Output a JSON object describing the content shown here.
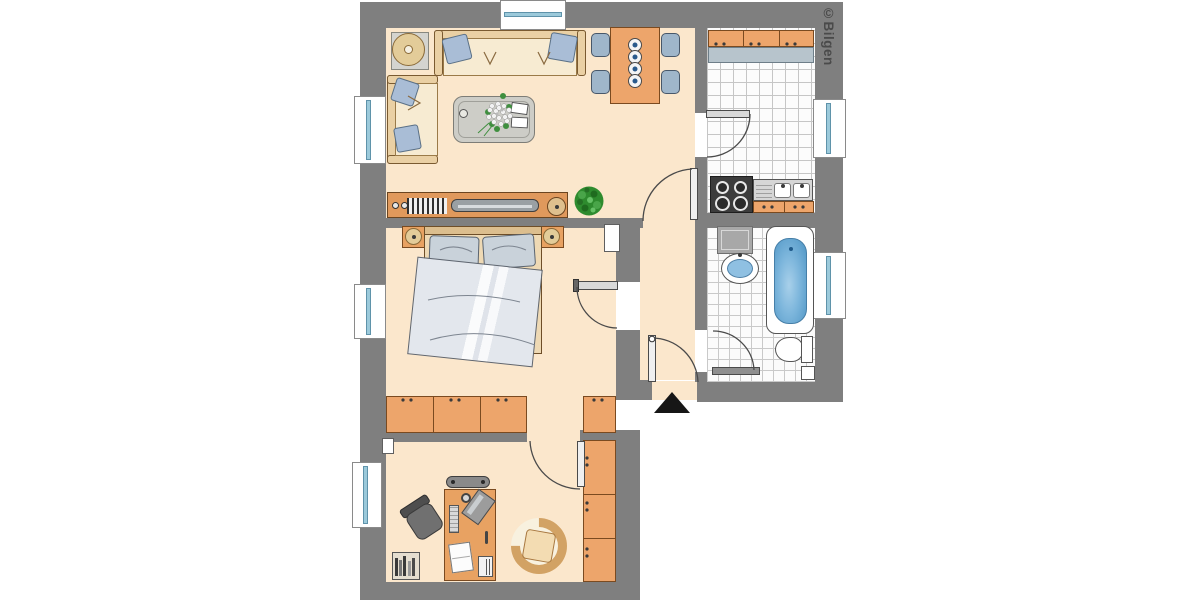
{
  "watermark": {
    "text": "©Bilgen"
  },
  "palette": {
    "wall": "#7f7f7f",
    "floor": "#fbe7cc",
    "cabinet_orange": "#eda56b",
    "desk_wood": "#e8a262",
    "upholstery_cream": "#f7ebd2",
    "pillow_blue": "#a9bdd6",
    "dining_chair_blue": "#9fb6ca",
    "kitchen_counter": "#b7c4cc",
    "tile_line_gray": "#c6c6c6",
    "bath_water_blue": "#5d9fcc",
    "window_glass": "#9ccadb",
    "plant_green": "#2e8b2e",
    "entrance_arrow": "#161616"
  },
  "plan": {
    "type": "apartment-floor-plan",
    "entrance_marker": "black-triangle-up",
    "windows_count": 6,
    "doors_count": 6,
    "rooms": [
      {
        "id": "living-room",
        "furniture": [
          "three-seat-sofa",
          "two-seat-sofa",
          "floor-lamp-with-table",
          "coffee-table",
          "flower-bouquet",
          "candle",
          "books",
          "dining-table",
          "dining-chairs-x4",
          "place-settings-x4",
          "sideboard",
          "tv",
          "cd-rack",
          "speaker-knobs",
          "round-speaker",
          "potted-plant"
        ]
      },
      {
        "id": "kitchen",
        "floor": "tiles",
        "furniture": [
          "wall-cabinet-row",
          "countertop",
          "stove-4-burners",
          "double-sink-with-drainboard",
          "base-cabinet"
        ]
      },
      {
        "id": "bathroom",
        "floor": "tiles",
        "furniture": [
          "washing-machine",
          "wash-basin",
          "bathtub",
          "toilet",
          "corner-shelf"
        ]
      },
      {
        "id": "hallway",
        "furniture": [
          "entrance-door"
        ]
      },
      {
        "id": "bedroom",
        "furniture": [
          "double-bed",
          "pillows-x2",
          "blanket",
          "nightstand-x2",
          "table-lamp-x2",
          "wardrobe-row-3-doors",
          "wardrobe-single"
        ]
      },
      {
        "id": "office",
        "furniture": [
          "desk",
          "monitor",
          "keyboard",
          "cup",
          "pen",
          "papers",
          "printer",
          "office-chair",
          "tub-chair",
          "wall-shelf",
          "wardrobe-column-3-doors",
          "bookshelf-with-books"
        ]
      }
    ]
  }
}
